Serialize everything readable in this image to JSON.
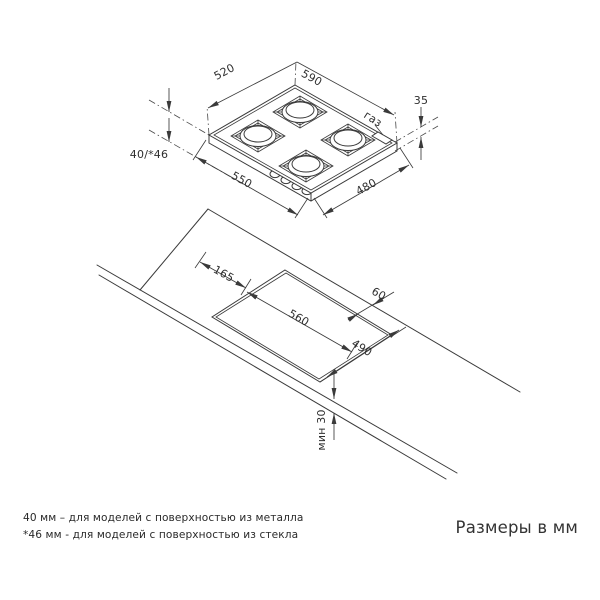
{
  "drawing_title": "Схема установки газовой варочной панели",
  "hob_view": {
    "dim_nw_edge": "520",
    "dim_ne_edge": "590",
    "dim_height_above": "35",
    "gas_label": "газ",
    "dim_depth_below": "40/*46",
    "dim_sw_edge": "550",
    "dim_se_edge": "480"
  },
  "counter_view": {
    "dim_left_offset": "165",
    "dim_cutout_width": "560",
    "dim_back_offset": "60",
    "dim_cutout_depth": "490",
    "dim_front_min": "мин 30"
  },
  "footnotes": {
    "metal": "40 мм – для моделей с поверхностью из металла",
    "glass": "*46 мм - для моделей с поверхностью из стекла"
  },
  "caption": "Размеры в мм"
}
